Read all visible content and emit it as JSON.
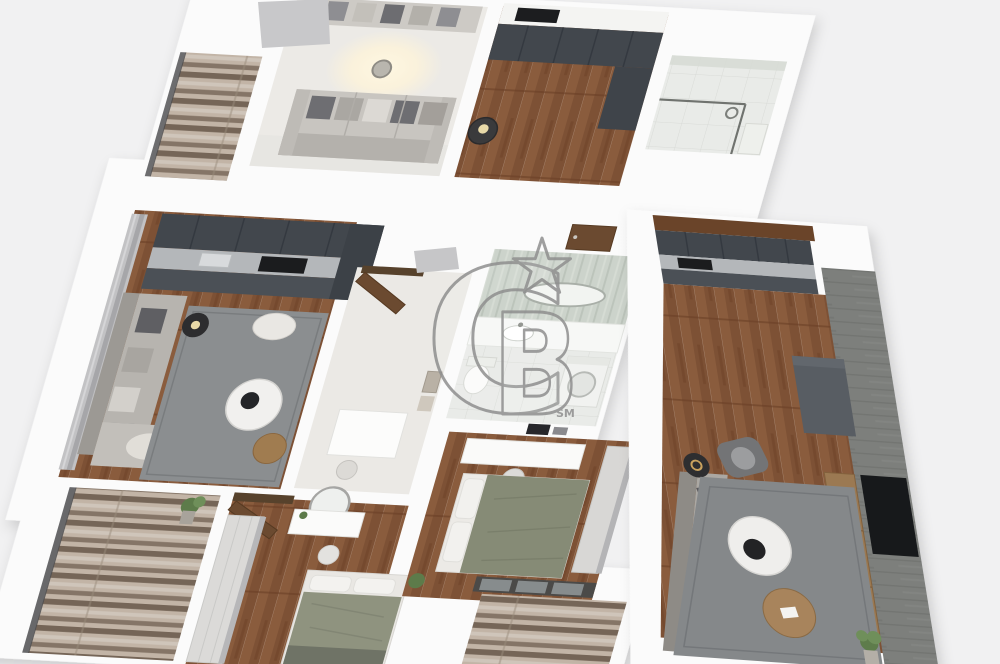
{
  "meta": {
    "description": "3D rendered top-down axonometric floor plan of an apartment, real-estate listing image",
    "canvas": {
      "width": 1000,
      "height": 664
    }
  },
  "watermark": {
    "monogram": "CB",
    "letter_c": "C",
    "letter_b": "B",
    "service_mark": "SM",
    "star": "five-point-star-outline",
    "color": "#8f8f8f"
  },
  "palette": {
    "background": "#f1f1f2",
    "wall": "#fbfbfb",
    "floor_light": "#eceae6",
    "wood_a": "#7d5135",
    "wood_b": "#8a5c3d",
    "wood_seam": "#6b4026",
    "marble_a": "#c2b4a6",
    "marble_b": "#756557",
    "tile": "#e9ebe8",
    "green_tile": "#ccd3cb",
    "accent_wall": "#7d7f7c",
    "rug": "#8b8e90",
    "cabinet_dark": "#42474d",
    "counter": "#b4b7ba",
    "sofa": "#c8c5c0",
    "bed_duvet": "#8f937f",
    "door_wood": "#6b4a30",
    "watermark": "#8f8f8f"
  },
  "scene": {
    "view": "axonometric-top-down",
    "units": [
      {
        "name": "upper-unit",
        "rooms": [
          "balcony-marble",
          "living-room-sofa-ceiling-light",
          "kitchen-dark-cabinets-wood-floor",
          "bathroom-shower-glass"
        ]
      },
      {
        "name": "middle-unit",
        "rooms": [
          "kitchen-living-room-sofa-rug-round-tables",
          "hallway-open-wood-door",
          "bathroom-vanity-washer-toilet"
        ]
      },
      {
        "name": "right-unit",
        "rooms": [
          "studio-living-kitchen-gray-accent-wall-tv-rug-coffee-tables"
        ]
      },
      {
        "name": "lower-row",
        "rooms": [
          "balcony-left-marble-plant",
          "bedroom-wardrobe-round-mirror-bed",
          "bedroom-desk-bed-wardrobe",
          "balcony-center-marble"
        ]
      }
    ]
  }
}
